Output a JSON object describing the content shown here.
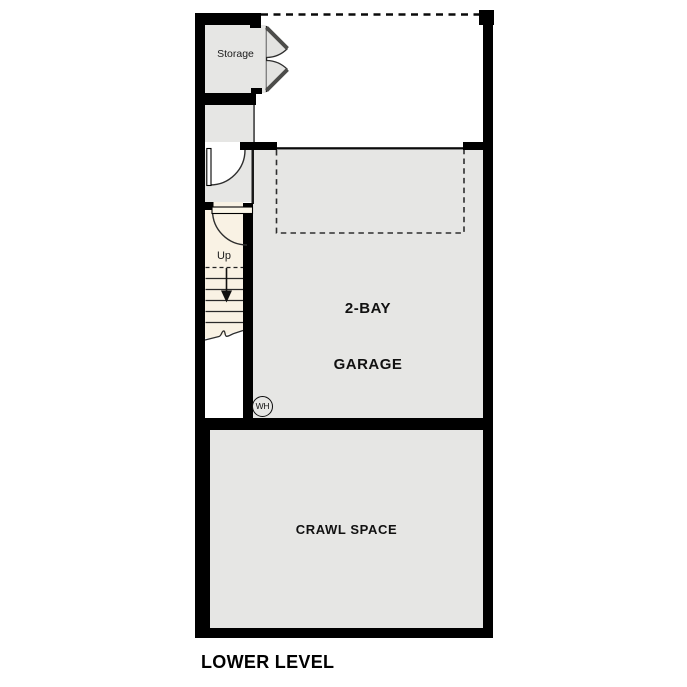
{
  "plan": {
    "title": "LOWER LEVEL",
    "rooms": {
      "storage": {
        "label": "Storage"
      },
      "garage": {
        "label_line1": "2-BAY",
        "label_line2": "GARAGE"
      },
      "crawl_space": {
        "label": "CRAWL SPACE"
      }
    },
    "stairs": {
      "direction_label": "Up"
    },
    "water_heater": {
      "label": "WH"
    }
  },
  "colors": {
    "walls": "#000000",
    "room_floor": "#e6e6e4",
    "stair_floor": "#f9f2e4",
    "door_swing": "#ffffff",
    "background": "#ffffff"
  }
}
